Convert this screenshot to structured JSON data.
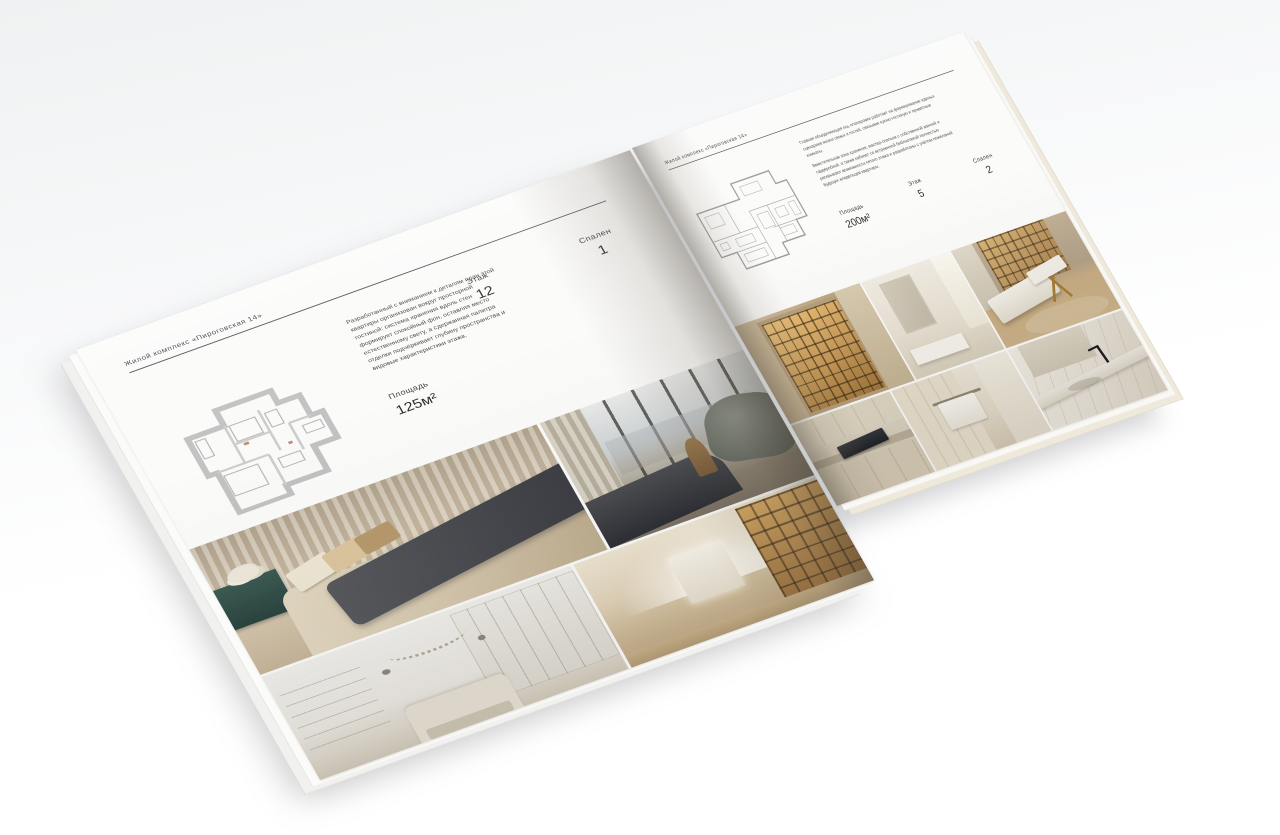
{
  "brochure": {
    "left_page": {
      "header": "Жилой комплекс «Пироговская 14»",
      "description": "Разработанный с вниманием к деталям план этой квартиры организован вокруг просторной гостиной: система хранения вдоль стен формирует спокойный фон, оставляя место естественному свету, а сдержанная палитра отделки подчёркивает глубину пространства и видовые характеристики этажа.",
      "area_label": "Площадь",
      "area_value": "125м²",
      "floor_label": "Этаж",
      "floor_value": "12",
      "bedrooms_label": "Спален",
      "bedrooms_value": "1"
    },
    "right_page": {
      "header": "Жилой комплекс «Пироговская 14»",
      "description_1": "Главная объединяющая ось планировки работает на формирование единых сценариев жизни семьи и гостей, связывая кухню-гостиную и приватные комнаты.",
      "description_2": "Вместительная зона хранения, мастер-спальня с собственной ванной и гардеробной, а также кабинет со встроенной библиотекой полностью раскрывают возможности пятого этажа и разработаны с учётом пожеланий будущих владельцев квартиры.",
      "area_label": "Площадь",
      "area_value": "200м²",
      "floor_label": "Этаж",
      "floor_value": "5",
      "bedrooms_label": "Спален",
      "bedrooms_value": "2"
    }
  }
}
